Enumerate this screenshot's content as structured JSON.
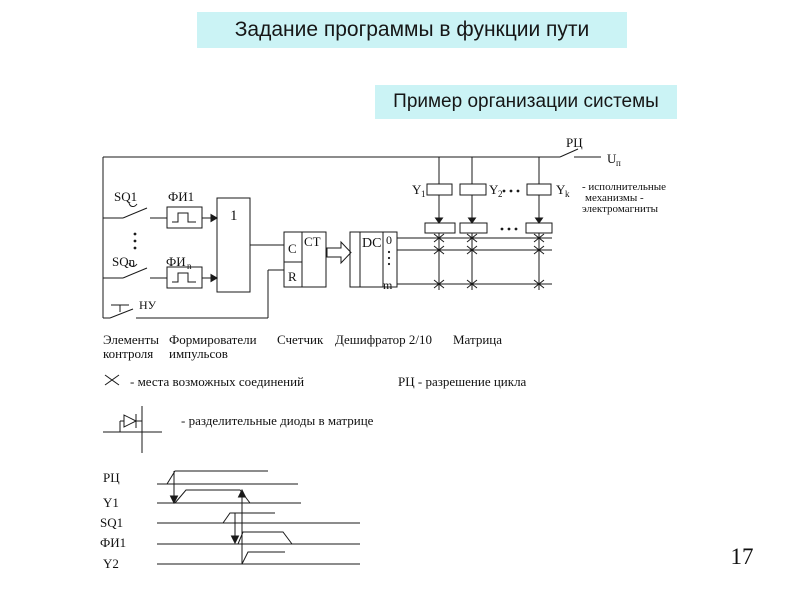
{
  "title": "Задание программы в функции пути",
  "subtitle": "Пример организации системы",
  "page_number": "17",
  "colors": {
    "banner_bg": "#cbf3f5",
    "line": "#1a1a1a",
    "background": "#ffffff"
  },
  "circuit": {
    "sq1": "SQ1",
    "sqn": "SQn",
    "fi1": "ФИ1",
    "fin": {
      "b": "ФИ",
      "s": "n"
    },
    "or_block": "1",
    "nu": "НУ",
    "ct": "CT",
    "c_input": "C",
    "r_input": "R",
    "dc": "DC",
    "out_top": "0",
    "out_bottom": "m",
    "rc_switch": "РЦ",
    "un": {
      "b": "U",
      "s": "п"
    },
    "y1": {
      "b": "Y",
      "s": "1"
    },
    "y2": {
      "b": "Y",
      "s": "2"
    },
    "yk": {
      "b": "Y",
      "s": "k"
    },
    "actuator_note_1": "- исполнительные",
    "actuator_note_2": "механизмы -",
    "actuator_note_3": "электромагниты"
  },
  "captions": {
    "elements_1": "Элементы",
    "elements_2": "контроля",
    "formers_1": "Формирователи",
    "formers_2": "импульсов",
    "counter": "Счетчик",
    "decoder": "Дешифратор 2/10",
    "matrix": "Матрица",
    "connections_legend": "- места возможных соединений",
    "rc_legend": "РЦ - разрешение цикла",
    "diode_legend": "- разделительные диоды в матрице"
  },
  "timing": {
    "rc": "РЦ",
    "y1": "Y1",
    "sq1": "SQ1",
    "fi1": "ФИ1",
    "y2": "Y2"
  }
}
